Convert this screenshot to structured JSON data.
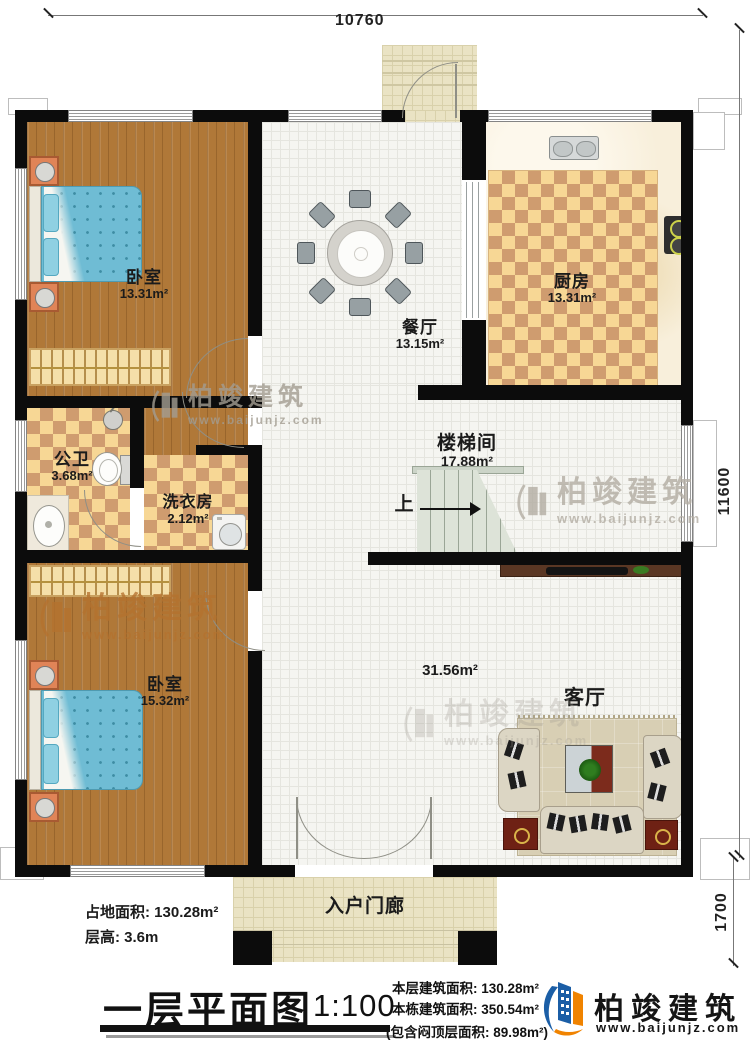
{
  "dimensions": {
    "top": "10760",
    "right": "11600",
    "porch": "1700"
  },
  "rooms": {
    "bedroom1": {
      "name": "卧室",
      "area": "13.31m²"
    },
    "dining": {
      "name": "餐厅",
      "area": "13.15m²"
    },
    "kitchen": {
      "name": "厨房",
      "area": "13.31m²"
    },
    "bathroom": {
      "name": "公卫",
      "area": "3.68m²"
    },
    "laundry": {
      "name": "洗衣房",
      "area": "2.12m²"
    },
    "stair": {
      "name": "楼梯间",
      "area": "17.88m²",
      "up": "上"
    },
    "bedroom2": {
      "name": "卧室",
      "area": "15.32m²"
    },
    "living": {
      "name": "客厅",
      "area": "31.56m²"
    },
    "porch": {
      "name": "入户门廊"
    }
  },
  "info": {
    "site": "占地面积: 130.28m²",
    "height": "层高: 3.6m"
  },
  "footer": {
    "title": "一层平面图",
    "scale": "1:100",
    "area1": "本层建筑面积: 130.28m²",
    "area2": "本栋建筑面积: 350.54m²",
    "area3": "(包含闷顶层面积: 89.98m²)",
    "brand": "柏竣建筑",
    "url": "www.baijunjz.com"
  },
  "watermark": {
    "brand": "柏竣建筑",
    "url": "www.baijunjz.com"
  },
  "colors": {
    "wall": "#0c0c0c",
    "wood": "#b07838",
    "checker_light": "#f7d795",
    "checker_dark": "#cf9c6f",
    "brand_blue": "#1b5ea6",
    "brand_orange": "#f08300"
  }
}
